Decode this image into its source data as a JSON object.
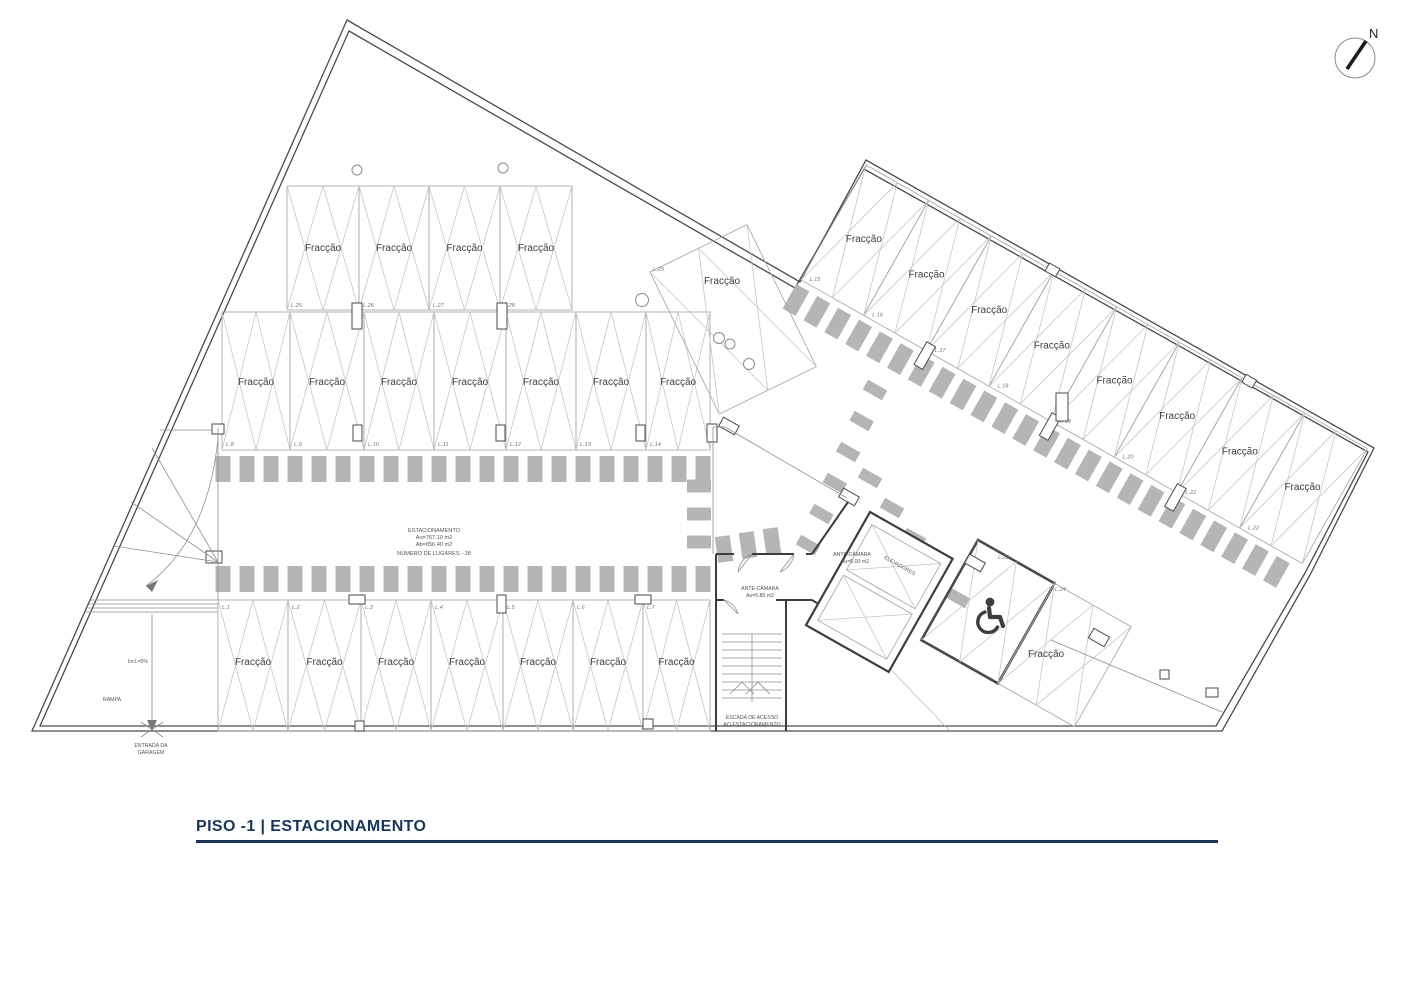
{
  "meta": {
    "sheet_title": "PISO -1 | ESTACIONAMENTO",
    "north_label": "N"
  },
  "colors": {
    "title_navy": "#17365d",
    "wall_gray": "#4a4a4a",
    "hatch_gray": "#b5b5b5"
  },
  "plan": {
    "stall_label": "Fracção",
    "stats_block": {
      "line1": "ESTACIONAMENTO",
      "line2": "Au=767.10 m2",
      "line3": "Ab=856.40 m2",
      "line4": "NÚMERO DE LUGARES - 28"
    },
    "ramp": {
      "rampa_label": "RAMPA",
      "incline_label": "Incl.=5%",
      "entrance_line1": "ENTRADA DA",
      "entrance_line2": "GARAGEM"
    },
    "stairs": {
      "label_line1": "ESCADA DE ACESSO",
      "label_line2": "AO ESTACIONAMENTO"
    },
    "rooms": {
      "antecamara_1_name": "ANTE-CÂMARA",
      "antecamara_1_area": "Au=5.00 m2",
      "antecamara_2_name": "ANTE-CÂMARA",
      "antecamara_2_area": "Au=5.80 m2",
      "elevators_label": "ELEVADORES"
    },
    "rows": {
      "top": [
        "L.25",
        "L.26",
        "L.27",
        "L.28"
      ],
      "middle": [
        "L.8",
        "L.9",
        "L.10",
        "L.11",
        "L.12",
        "L.13",
        "L.14"
      ],
      "bottom": [
        "L.1",
        "L.2",
        "L.3",
        "L.4",
        "L.5",
        "L.6",
        "L.7"
      ],
      "wing": [
        "L.15",
        "L.16",
        "L.17",
        "L.18",
        "L.19",
        "L.20",
        "L.21",
        "L.22"
      ],
      "free": [
        "L.29",
        "L.23",
        "L.24"
      ]
    }
  }
}
